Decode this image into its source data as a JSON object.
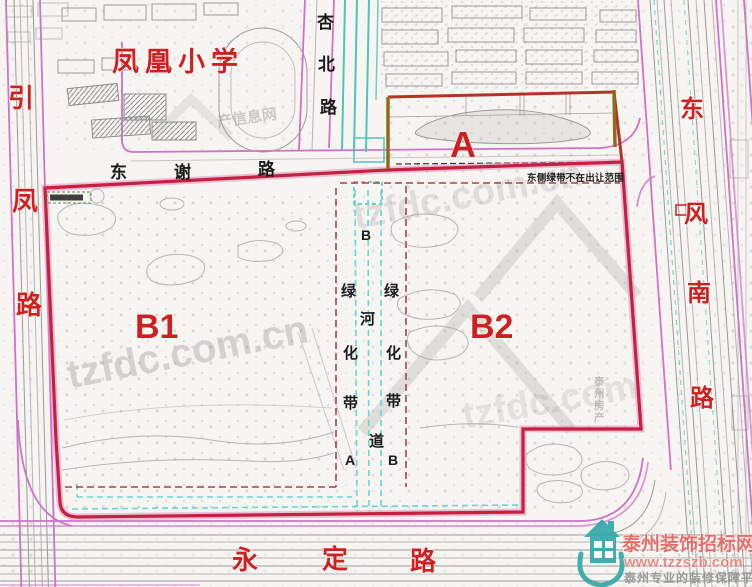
{
  "parcels": {
    "a": "A",
    "b1": "B1",
    "b2": "B2"
  },
  "school": {
    "name": "凤凰小学"
  },
  "roads": {
    "yinfeng": {
      "chars": [
        "引",
        "凤",
        "路"
      ]
    },
    "xingbei": {
      "chars": [
        "杏",
        "北",
        "路"
      ]
    },
    "dongxie": {
      "chars": [
        "东",
        "谢",
        "路"
      ]
    },
    "dongfengnan": {
      "chars": [
        "东",
        "风",
        "南",
        "路"
      ]
    },
    "yongding": {
      "chars": [
        "永",
        "定",
        "路"
      ]
    }
  },
  "greenbelt": {
    "left": [
      "绿",
      "化",
      "带"
    ],
    "right": [
      "绿",
      "化",
      "带"
    ],
    "river": [
      "河",
      "道"
    ],
    "marker_top": "B",
    "marker_bottom_left": "A",
    "marker_bottom_right": "B"
  },
  "note": {
    "text": "东侧绿带不在出让范围"
  },
  "watermarks": {
    "tzfdc_main": "tzfdc.com.cn",
    "tzfdc_upper": "tzfdc.com.cn",
    "tzfdc_lower": "tzfdc.com",
    "info_net": "产信息网",
    "vertical": [
      "泰",
      "州",
      "房",
      "产"
    ]
  },
  "logo": {
    "title": "泰州装饰招标网",
    "url": "www.tzzszb.com",
    "tagline": "泰州专业的装修保障平台"
  },
  "colors": {
    "label_red": "#cf1f1f",
    "boundary_red": "#c5203f",
    "boundary_pink": "#e08fc0",
    "boundary_brown": "#8f6b1e",
    "road_magenta": "#cf72c8",
    "river_teal": "#4fc3bd",
    "river_cyan": "#63d8d8",
    "dashed_maroon": "#a84250",
    "text_black": "#1b1b1b",
    "logo_teal": "#2fa7a7",
    "logo_red": "#e2635f",
    "logo_gray": "#9a9a9a",
    "watermark_gray": "#8a8a8a"
  }
}
